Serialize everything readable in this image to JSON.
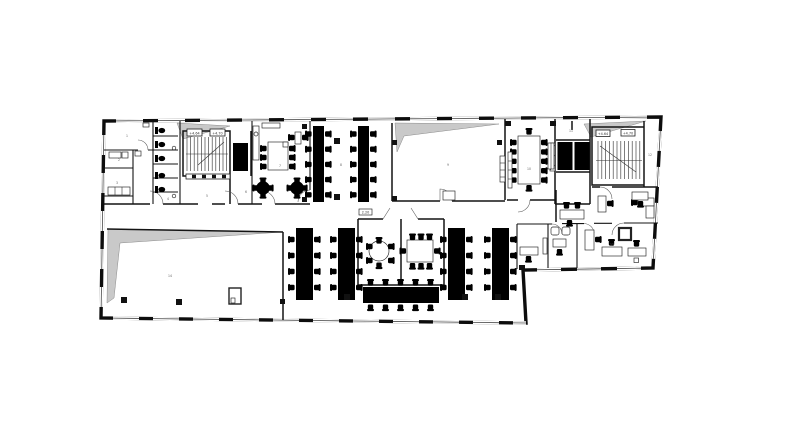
{
  "plan": {
    "type": "architectural-floor-plan",
    "colors": {
      "wall": "#111111",
      "shade": "#c9c9c9",
      "background": "#ffffff",
      "label": "#444444"
    },
    "labels": {
      "stair_west_a": "+4.64",
      "stair_west_b": "+4.70",
      "stair_east_a": "+4.64",
      "stair_east_b": "+4.70",
      "meeting_tag": "2.20",
      "rooms": [
        "1",
        "2",
        "3",
        "4",
        "5",
        "6",
        "7",
        "8",
        "9",
        "10",
        "11",
        "12",
        "13",
        "14"
      ]
    },
    "spaces": [
      "stair-west",
      "wc-block",
      "kitchen-break-room",
      "open-office-north",
      "hall-north",
      "conference-room",
      "elevator-lobby",
      "stair-east",
      "offices-east",
      "hall-south",
      "open-office-south",
      "meeting-room-round",
      "meeting-room-rect",
      "lounge"
    ]
  }
}
